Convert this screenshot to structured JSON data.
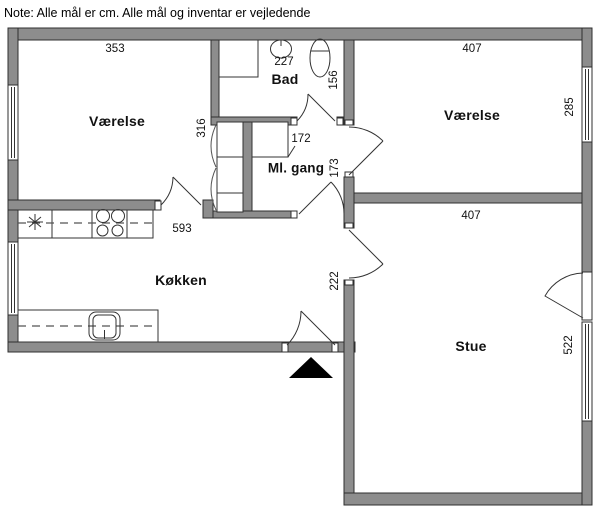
{
  "note": "Note: Alle mål er cm. Alle mål og inventar er vejledende",
  "rooms": {
    "bedroom_left": {
      "label": "Værelse",
      "width_cm": "353",
      "depth_cm": "316"
    },
    "bathroom": {
      "label": "Bad",
      "width_cm": "227",
      "depth_cm": "156"
    },
    "hallway": {
      "label": "Ml. gang",
      "width_cm": "172",
      "depth_cm": "173"
    },
    "bedroom_right": {
      "label": "Værelse",
      "width_cm": "407",
      "depth_cm": "285"
    },
    "kitchen": {
      "label": "Køkken",
      "width_cm": "593",
      "entry_depth_cm": "222"
    },
    "living_room": {
      "label": "Stue",
      "width_cm": "407",
      "depth_cm": "522"
    }
  },
  "symbols": {
    "entrance_marker": "filled-triangle-up",
    "fridge_symbol": "snowflake-asterisk",
    "stove_symbol": "four-burners",
    "window_symbol": "double-line-in-wall"
  },
  "colors": {
    "background": "#ffffff",
    "wall_fill": "#8d8d8d",
    "wall_outline": "#2f2f2f",
    "fixture_line": "#333333",
    "entrance_arrow": "#000000",
    "text": "#111111"
  }
}
